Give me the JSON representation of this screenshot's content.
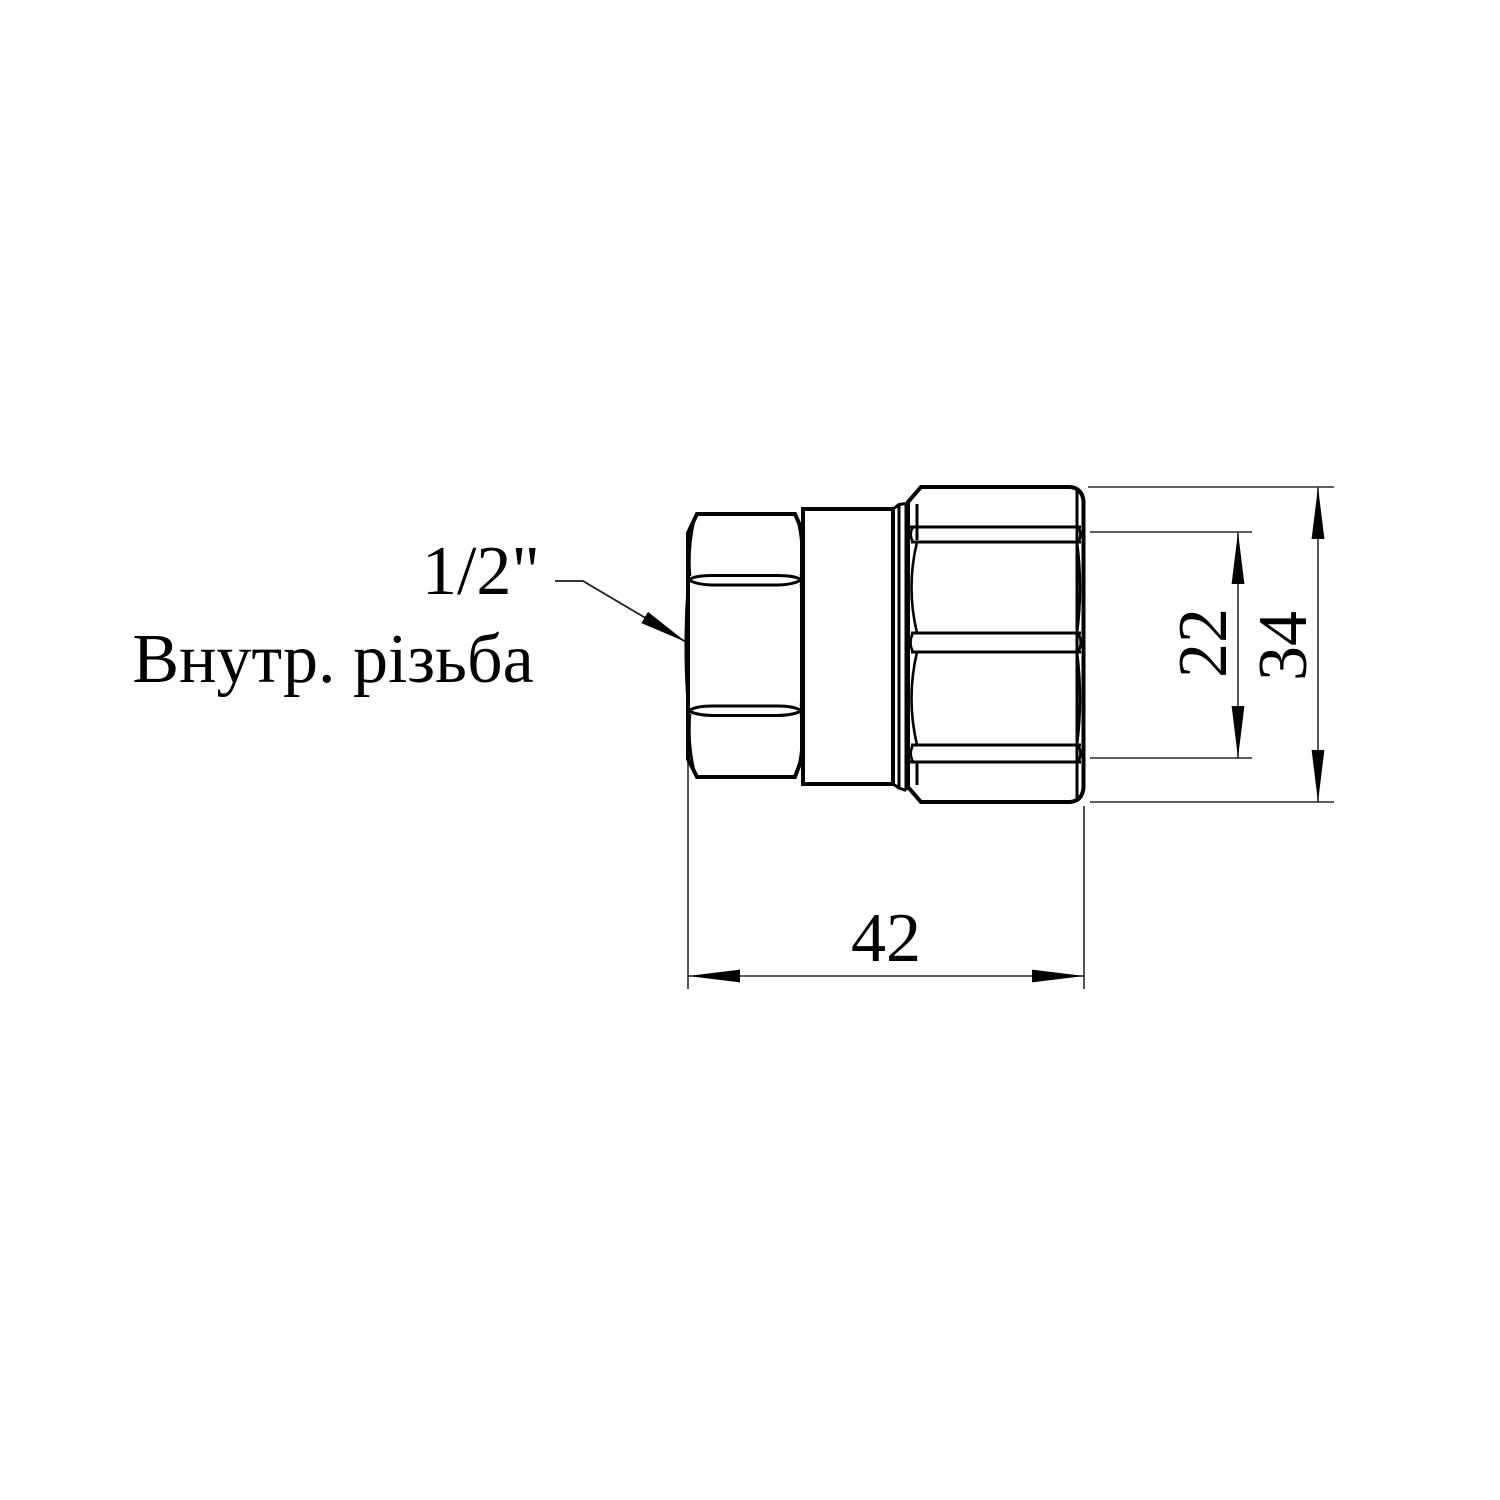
{
  "drawing": {
    "title": "pipe fitting technical drawing",
    "callout": {
      "thread_size": "1/2\"",
      "thread_label": "Внутр. різьба"
    },
    "dimensions": {
      "overall_length": "42",
      "thread_diameter": "22",
      "body_diameter": "34"
    },
    "colors": {
      "line": "#000000",
      "dimension_line": "#2a2a2a",
      "background": "#ffffff"
    }
  }
}
